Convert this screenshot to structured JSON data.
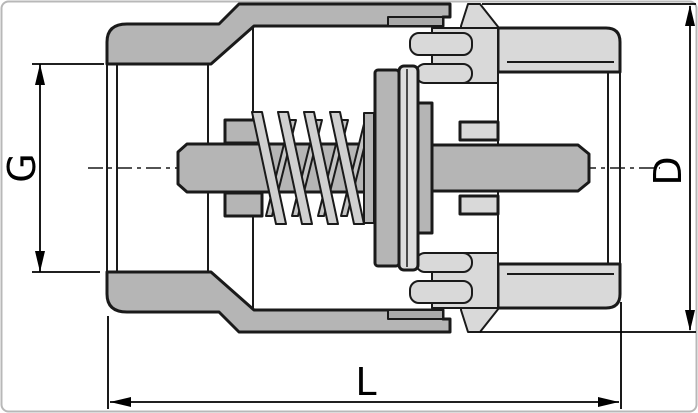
{
  "drawing": {
    "title": "check-valve-cross-section",
    "labels": {
      "thread": "G",
      "diameter": "D",
      "length": "L"
    },
    "colors": {
      "background": "#ffffff",
      "frame": "#b8b8b8",
      "outline": "#1a1a1a",
      "dimension": "#000000",
      "body_left": "#b5b5b5",
      "body_right": "#d9d9d9",
      "seal": "#dedede",
      "spring_front": "#d0d0d0",
      "spring_back": "#c4c4c4",
      "step_accent": "#a9a9a9"
    }
  }
}
